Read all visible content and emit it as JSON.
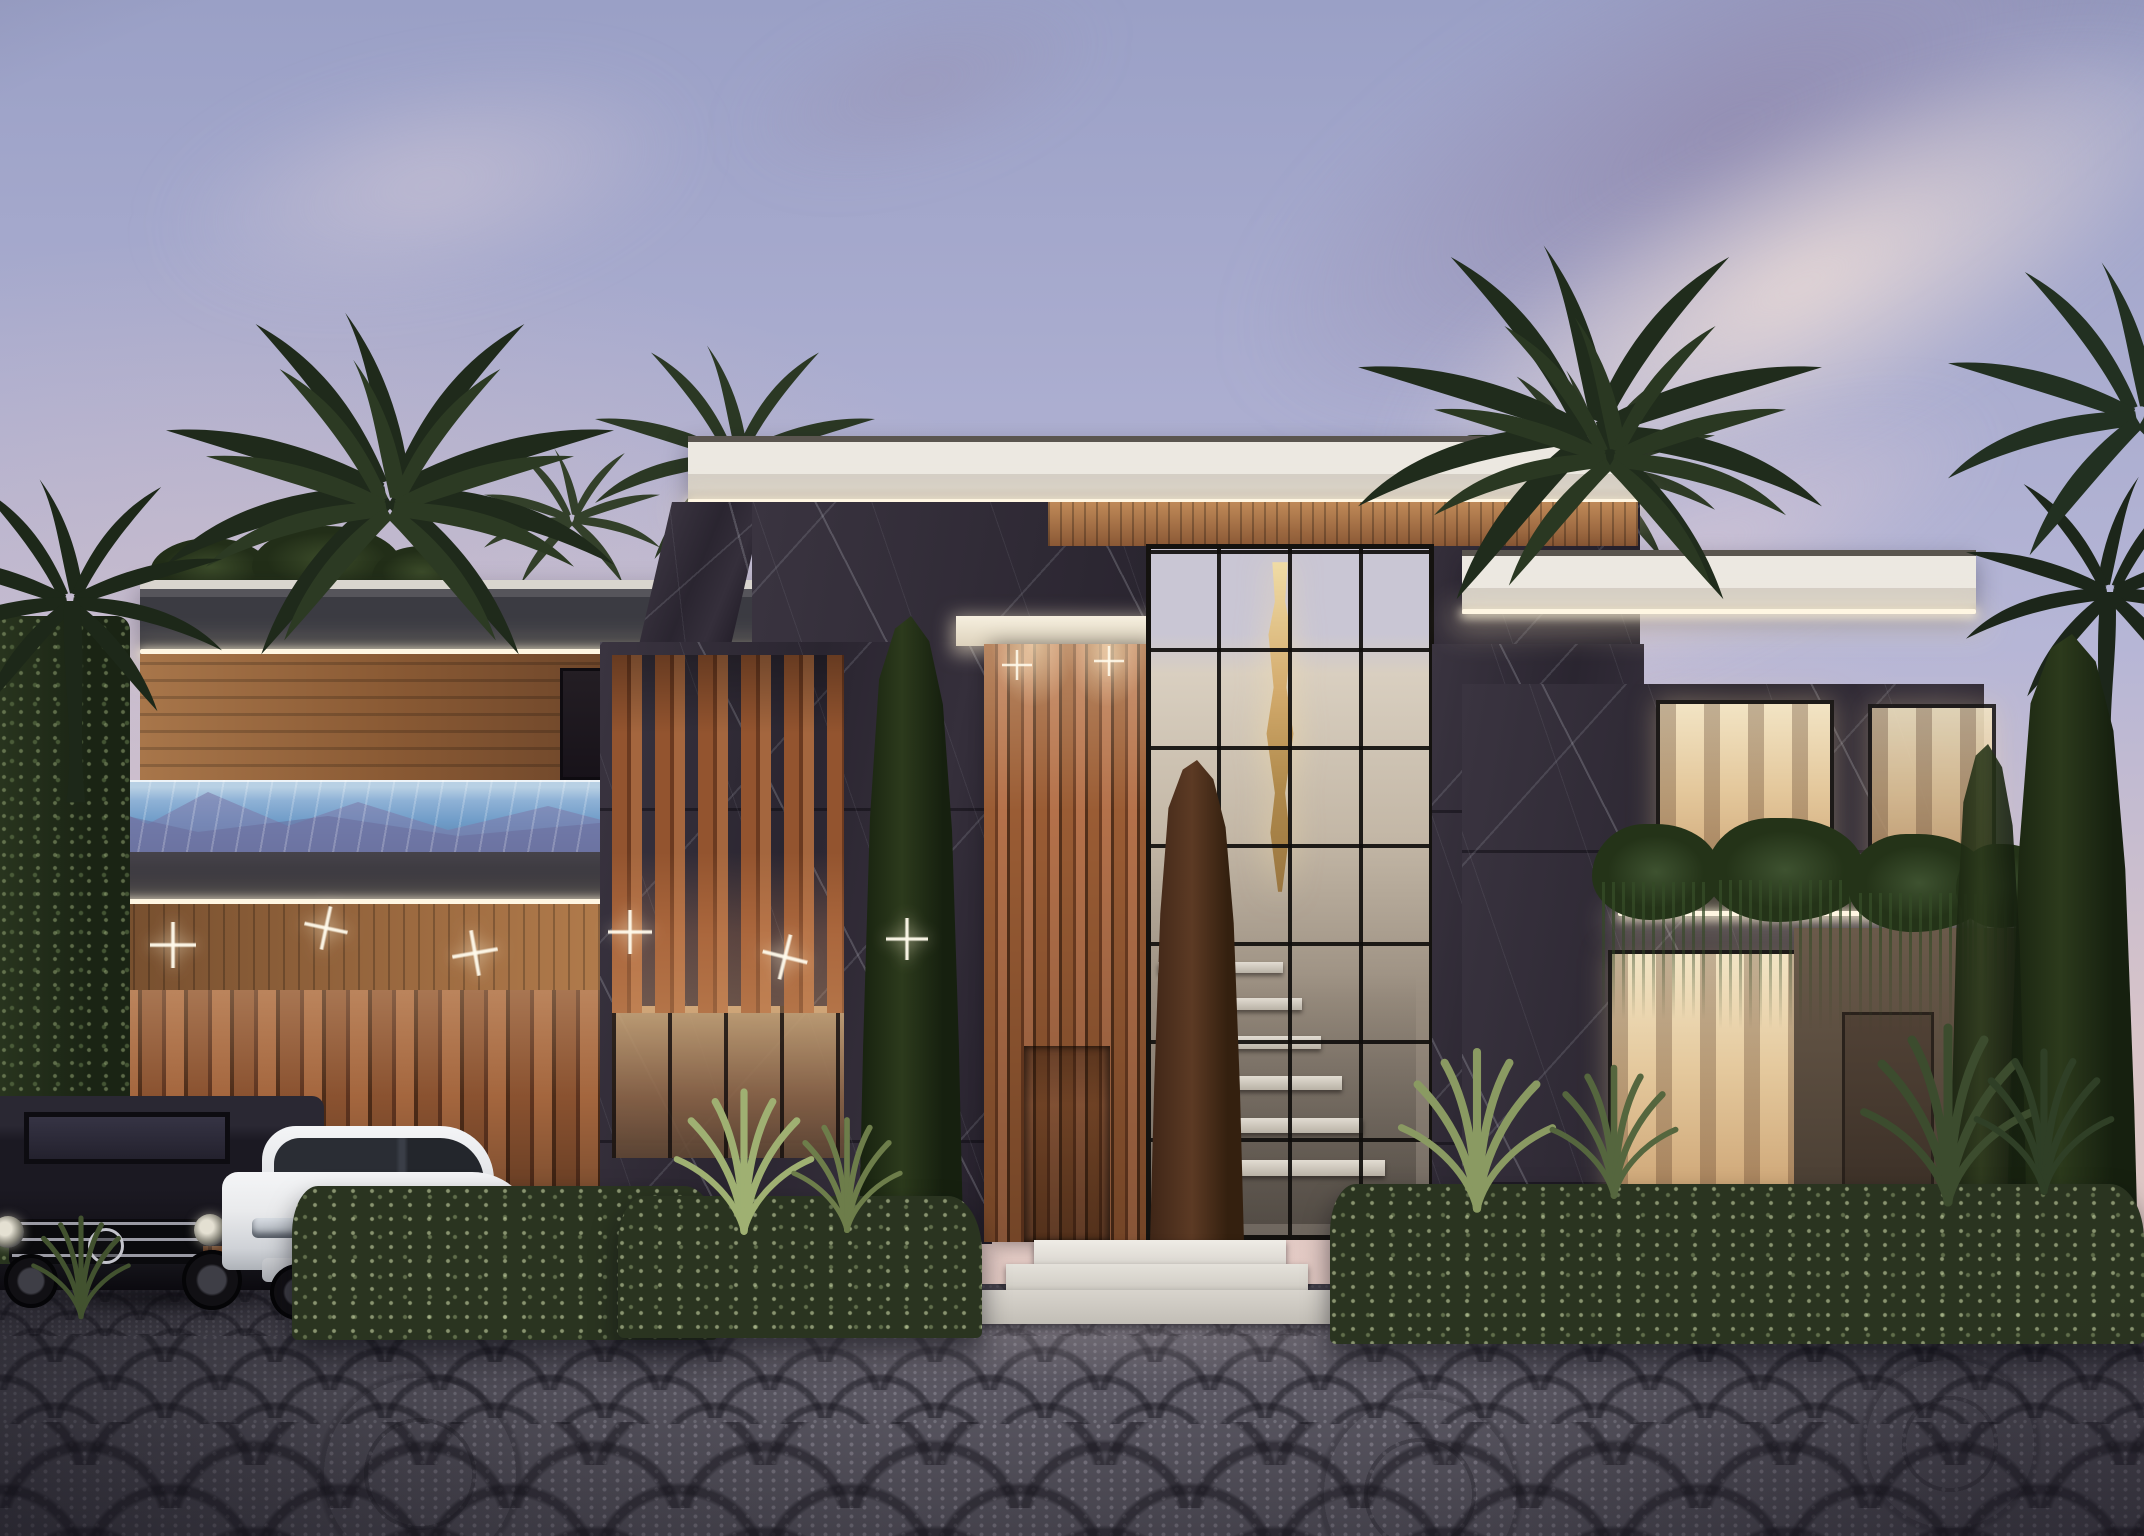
{
  "meta": {
    "kind": "architectural exterior rendering",
    "subject": "Modern two-storey luxury villa at dusk",
    "canvas": {
      "width": 2144,
      "height": 1536
    },
    "visible_text": "none"
  },
  "scene": {
    "sky": {
      "time_of_day": "dusk",
      "description": "Lavender-blue dusk sky with mauve and cream cirrus bands sweeping diagonally toward the upper right, warm peach glow low near the horizon"
    },
    "building": {
      "style": "contemporary flat-roof villa",
      "materials": [
        "black marble cladding with white veining",
        "warm vertical timber slats",
        "floor-to-ceiling glazing with black mullions",
        "white stone fasciae"
      ],
      "lighting": "warm LED strips under every roof fascia and balcony edge, star-burst downlights in the carport soffit, warmly lit interiors",
      "left_wing": [
        "glass-walled rooftop infinity pool with blue water and mountain reflections",
        "dark fascia band with LED strip",
        "timber-soffit carport",
        "vertical timber garage wall",
        "ivy-covered wall at the far left edge"
      ],
      "central_block": [
        "white flat roof slab",
        "double-height glass atrium showing a floating staircase",
        "cascading gold chandelier",
        "timber-slat entrance pylon with recessed front door",
        "white marble entry steps",
        "vertical timber fin screen over marble"
      ],
      "right_wing": [
        "marble volumes with LED-lit fasciae",
        "warm bedroom windows upstairs",
        "planted balcony with trailing greenery",
        "large living-room window",
        "side wall with service door"
      ]
    },
    "vegetation": [
      "silhouetted date palms left, right and far right",
      "columnar cypress trees flanking the entrance and at the right boundary",
      "clipped hedges with silver leaf highlights",
      "agaves and ornamental grasses",
      "trailing plants over the balcony",
      "ivy wall"
    ],
    "vehicles": [
      {
        "name": "black SUV",
        "description": "Dark Mercedes G-Class style boxy SUV with chrome bar grille, round headlights and roof rack, parked in the carport, cropped by the left edge"
      },
      {
        "name": "white SUV",
        "description": "White BMW X-series style coupe SUV with twin kidney grille, parked beside it facing the viewer"
      }
    ],
    "foreground": "Ornate grey cobblestone driveway laid in fan and rosette patterns, soft pool of light at centre, hedges screening the house base"
  },
  "palette": {
    "sky-top": "#9aa0c6",
    "sky-mid": "#b6b6d6",
    "sky-horizon": "#d9c4c8",
    "sky-glow": "#eed8c8",
    "cloud-dark": "#8e84a8",
    "cloud-light": "#efdfda",
    "roof-white-hi": "#ece8e1",
    "roof-white-lo": "#b2aba2",
    "fascia-dark": "#3b3b42",
    "led": "#fff6e2",
    "marble-hi": "#3a3440",
    "marble-lo": "#241f2a",
    "wood-hi": "#b4714a",
    "wood-mid": "#8a5230",
    "wood-lo": "#5a3420",
    "soffit-hi": "#c08a58",
    "glass-warm-hi": "#f2e4c4",
    "glass-warm-lo": "#caa070",
    "pool-hi": "#b8d0e4",
    "pool-mid": "#6f9cc8",
    "pool-lo": "#587ea6",
    "mountain": "#7d7cab",
    "interior-hi": "#d9cfc0",
    "interior-lo": "#6e665e",
    "gold-hi": "#f0dca6",
    "gold-lo": "#9a7640",
    "step-white": "#e6e3de",
    "hedge-base": "#2a3420",
    "cypress-green": "#1c2814",
    "cypress-rust": "#5c3a24",
    "ivy": "#202a18",
    "drive-base": "#5a5762",
    "drive-dark": "#34313c",
    "drive-dot": "#9b98a4",
    "car-black": "#17151b",
    "car-white": "#e9eaec"
  }
}
